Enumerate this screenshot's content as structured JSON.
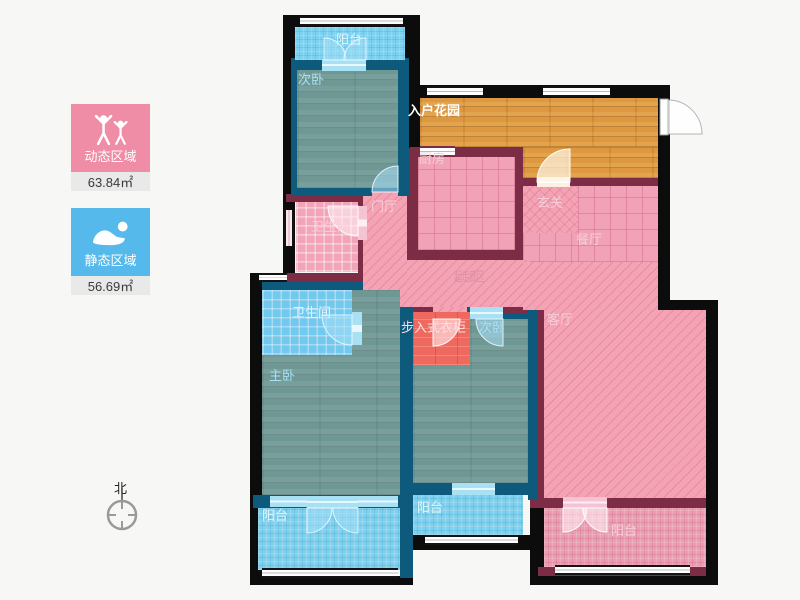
{
  "legend": {
    "dynamic": {
      "title": "动态区域",
      "area": "63.84㎡",
      "color": "#f08da6",
      "icon": "people-active-icon"
    },
    "static": {
      "title": "静态区域",
      "area": "56.69㎡",
      "color": "#55b9ec",
      "icon": "person-sleeping-icon"
    }
  },
  "compass": {
    "north_label": "北"
  },
  "rooms": {
    "balcony_top": "阳台",
    "bedroom_top": "次卧",
    "entry_garden": "入户花园",
    "kitchen": "厨房",
    "foyer": "门厅",
    "bath_top": "卫生间",
    "hallway": "玄关",
    "dining": "餐厅",
    "corridor": "起走廊区",
    "living": "客厅",
    "bath_master": "卫生间",
    "master": "主卧",
    "closet": "步入式衣柜",
    "bedroom_mid": "次卧",
    "balcony_master": "阳台",
    "balcony_mid": "阳台",
    "balcony_living": "阳台"
  },
  "palette": {
    "background": "#f7f7f6",
    "wall_outer": "#0c0c0c",
    "wall_pink_zone": "#7d2c46",
    "wall_blue_zone": "#0e5a7c",
    "floor_wood_teal": "#6f9894",
    "floor_tile_lightblue": "#7fd2ef",
    "floor_tile_pink": "#f1a2b6",
    "floor_hatch_pink": "#f3a3b4",
    "floor_wood_orange": "#dd9840",
    "floor_closet_red": "#f0695e"
  }
}
